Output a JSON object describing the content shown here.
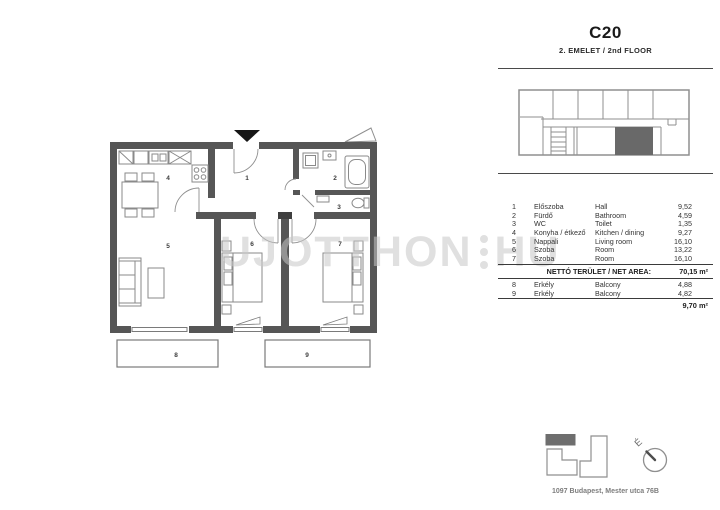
{
  "header": {
    "unit_code": "C20",
    "floor_label": "2. EMELET / 2nd FLOOR"
  },
  "floor_plan": {
    "room_labels": [
      "1",
      "2",
      "3",
      "4",
      "5",
      "6",
      "7",
      "8",
      "9"
    ]
  },
  "watermark": {
    "left": "UJOTTHON",
    "right": "HU"
  },
  "legend": {
    "rows": [
      {
        "num": "1",
        "hu": "Előszoba",
        "en": "Hall",
        "area": "9,52"
      },
      {
        "num": "2",
        "hu": "Fürdő",
        "en": "Bathroom",
        "area": "4,59"
      },
      {
        "num": "3",
        "hu": "WC",
        "en": "Toilet",
        "area": "1,35"
      },
      {
        "num": "4",
        "hu": "Konyha / étkező",
        "en": "Kitchen / dining",
        "area": "9,27"
      },
      {
        "num": "5",
        "hu": "Nappali",
        "en": "Living room",
        "area": "16,10"
      },
      {
        "num": "6",
        "hu": "Szoba",
        "en": "Room",
        "area": "13,22"
      },
      {
        "num": "7",
        "hu": "Szoba",
        "en": "Room",
        "area": "16,10"
      }
    ],
    "net_area_label": "NETTÓ TERÜLET / NET AREA:",
    "net_area_value": "70,15 m²",
    "balcony_rows": [
      {
        "num": "8",
        "hu": "Erkély",
        "en": "Balcony",
        "area": "4,88"
      },
      {
        "num": "9",
        "hu": "Erkély",
        "en": "Balcony",
        "area": "4,82"
      }
    ],
    "balcony_total": "9,70 m²"
  },
  "footer": {
    "address": "1097 Budapest, Mester utca 76B",
    "compass_label": "É"
  },
  "colors": {
    "wall": "#565656",
    "unit_highlight": "#696969",
    "site_highlight": "#6e6e6e"
  }
}
